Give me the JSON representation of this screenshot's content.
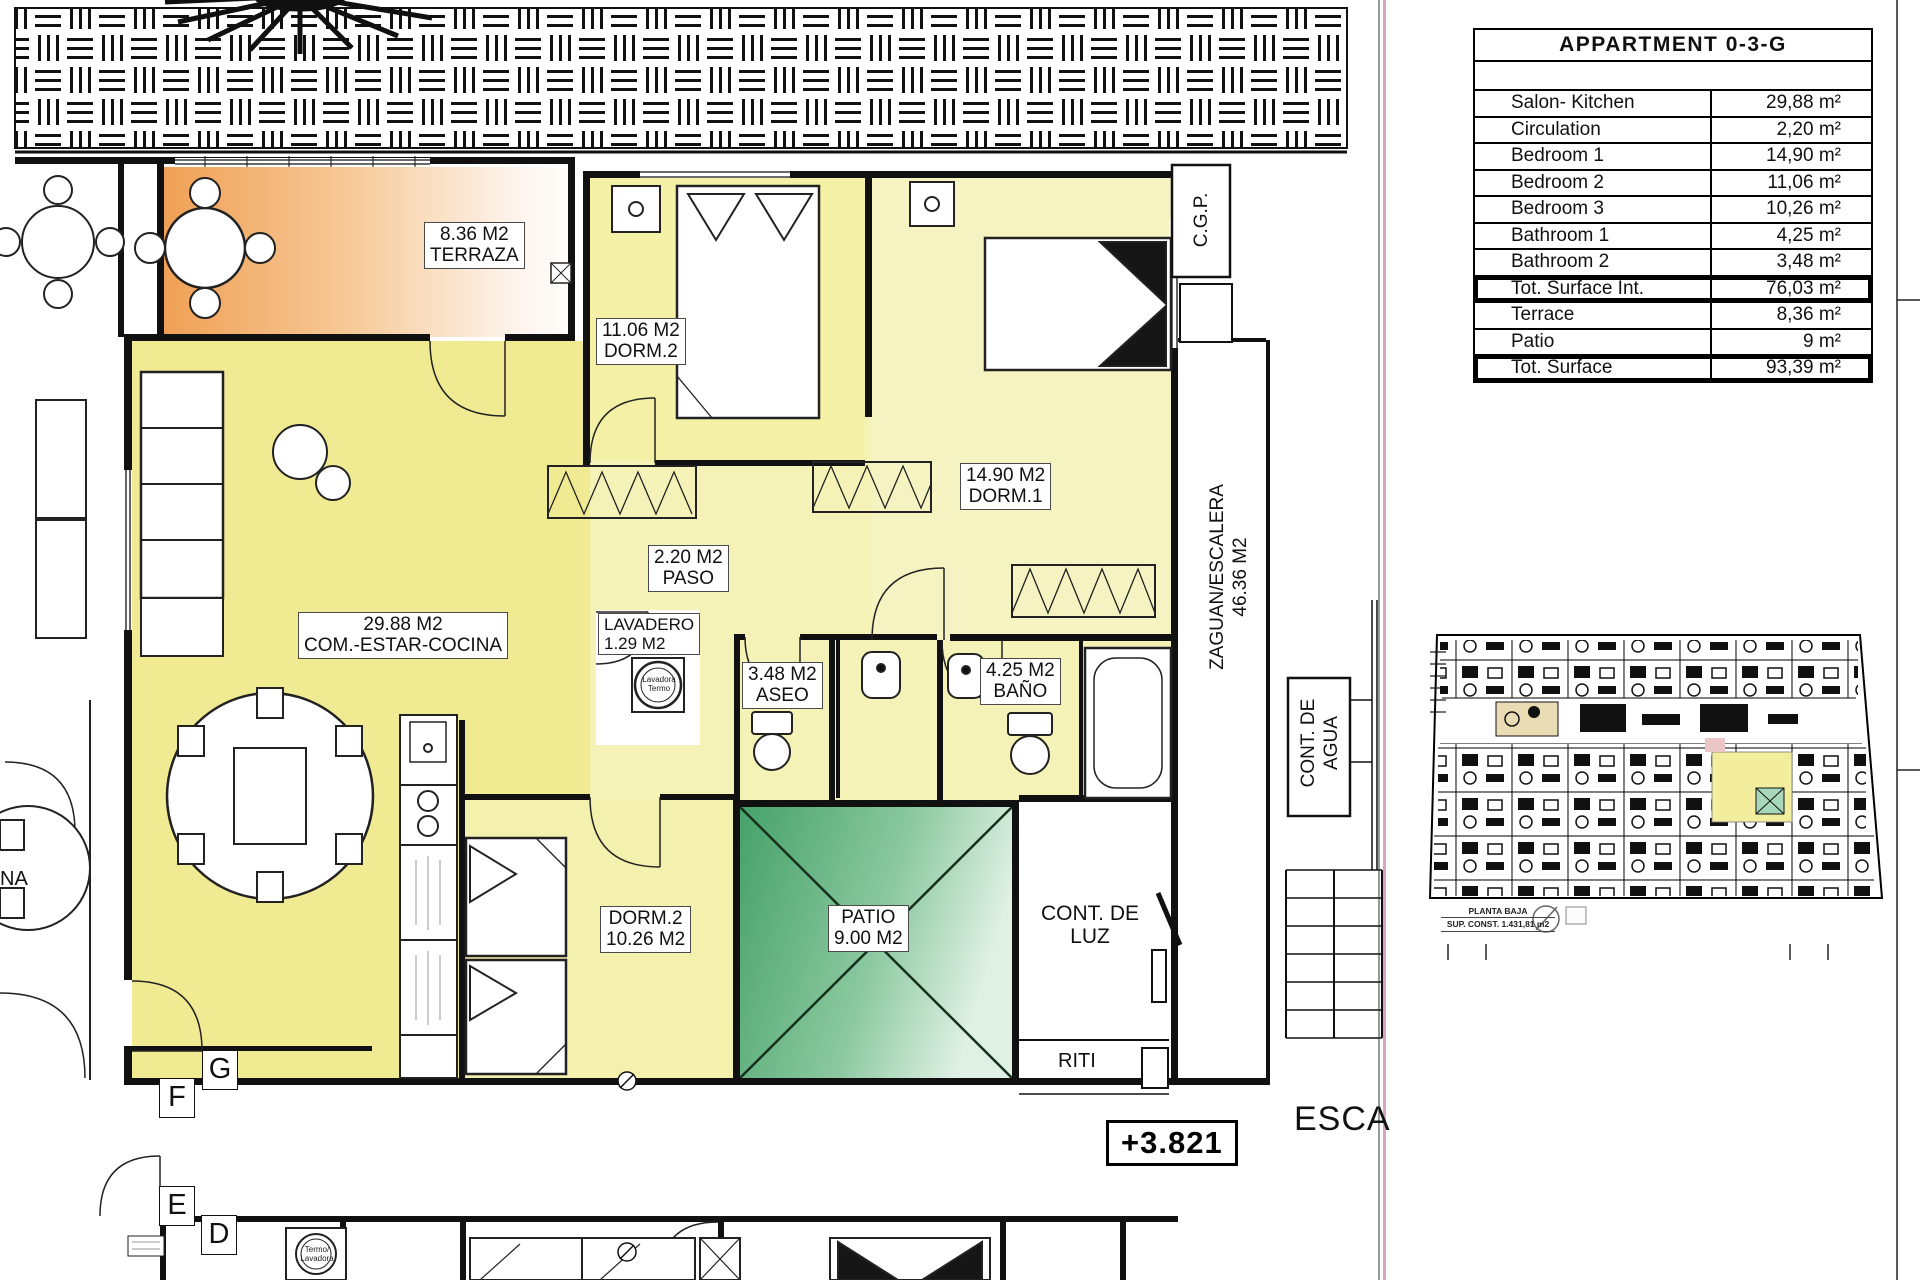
{
  "table": {
    "title": "APPARTMENT 0-3-G",
    "rows": [
      {
        "label": "Salon- Kitchen",
        "value": "29,88 m²"
      },
      {
        "label": "Circulation",
        "value": "2,20 m²"
      },
      {
        "label": "Bedroom 1",
        "value": "14,90 m²"
      },
      {
        "label": "Bedroom 2",
        "value": "11,06 m²"
      },
      {
        "label": "Bedroom 3",
        "value": "10,26 m²"
      },
      {
        "label": "Bathroom 1",
        "value": "4,25 m²"
      },
      {
        "label": "Bathroom 2",
        "value": "3,48 m²"
      },
      {
        "label": "Tot. Surface Int.",
        "value": "76,03 m²"
      },
      {
        "label": "Terrace",
        "value": "8,36 m²"
      },
      {
        "label": "Patio",
        "value": "9 m²"
      },
      {
        "label": "Tot. Surface",
        "value": "93,39 m²"
      }
    ]
  },
  "plan": {
    "labels": {
      "terraza": {
        "area": "8.36 M2",
        "name": "TERRAZA"
      },
      "dorm2": {
        "area": "11.06 M2",
        "name": "DORM.2"
      },
      "dorm1": {
        "area": "14.90 M2",
        "name": "DORM.1"
      },
      "paso": {
        "area": "2.20 M2",
        "name": "PASO"
      },
      "salon": {
        "area": "29.88 M2",
        "name": "COM.-ESTAR-COCINA"
      },
      "lavadero": {
        "name": "LAVADERO",
        "area": "1.29 M2"
      },
      "aseo": {
        "area": "3.48 M2",
        "name": "ASEO"
      },
      "bano": {
        "area": "4.25 M2",
        "name": "BAÑO"
      },
      "dorm3": {
        "name": "DORM.2",
        "area": "10.26 M2"
      },
      "patio": {
        "name": "PATIO",
        "area": "9.00 M2"
      },
      "cont_luz_1": "CONT. DE",
      "cont_luz_2": "LUZ",
      "riti": "RITI",
      "zaguan_1": "ZAGUAN/ESCALERA",
      "zaguan_2": "46.36 M2",
      "cont_agua_1": "CONT. DE",
      "cont_agua_2": "AGUA",
      "cgp": "C.G.P.",
      "esca": "ESCA",
      "level_marker": "+3.821",
      "na": "NA",
      "washer": {
        "l1": "Lavadora",
        "l2": "Termo"
      },
      "washer2": {
        "l1": "Termo/",
        "l2": "Lavadora"
      },
      "letters": {
        "g": "G",
        "f": "F",
        "e": "E",
        "d": "D"
      }
    }
  },
  "key_plan": {
    "caption_line1": "PLANTA BAJA",
    "caption_line2": "SUP. CONST. 1.431,81 m2"
  },
  "colors": {
    "terrace_orange": "#f0a055",
    "patio_green": "#46a169",
    "salon_yellow": "#f0eb92",
    "pale_yellow": "#f5f2b8",
    "frame_pink": "#dba3c0"
  }
}
